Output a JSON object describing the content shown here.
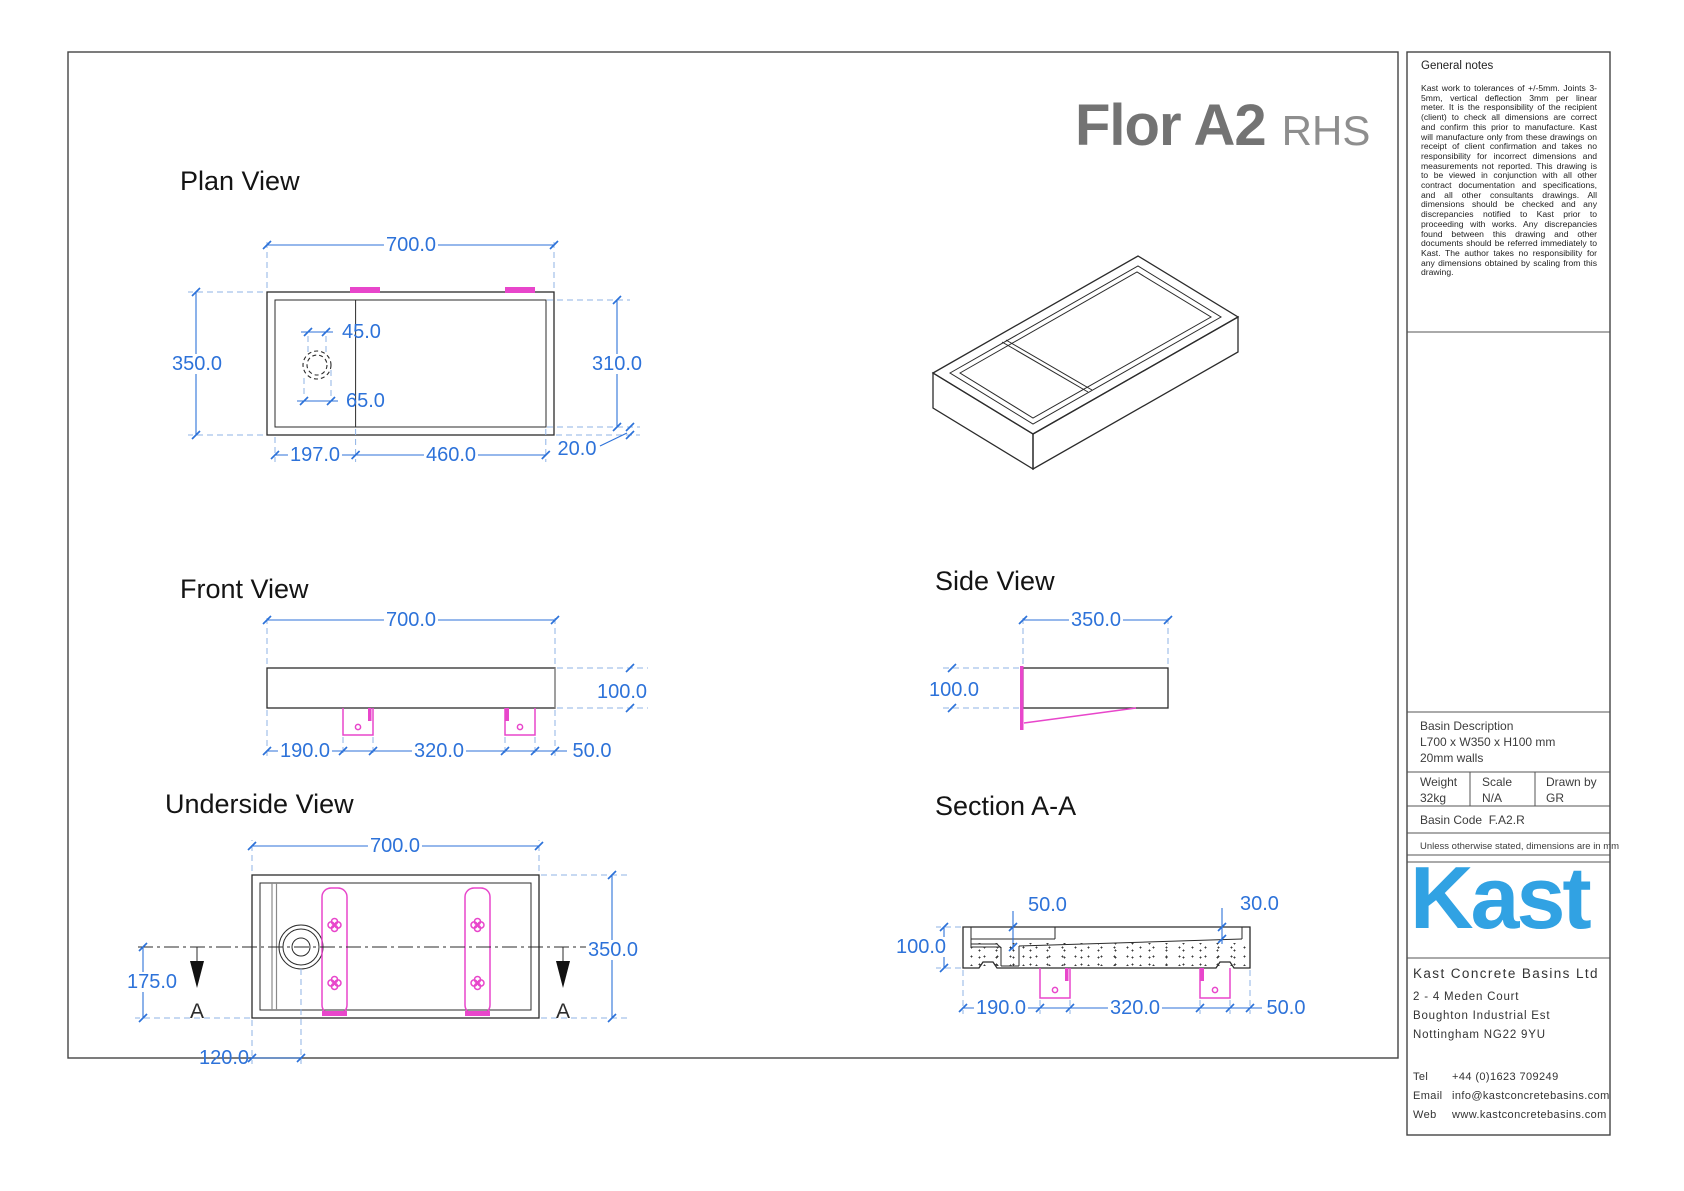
{
  "page": {
    "product_title": "Flor A2",
    "product_variant": "RHS"
  },
  "plan_view": {
    "title": "Plan View",
    "dim_width": "700.0",
    "dim_depth": "350.0",
    "dim_inner_depth": "310.0",
    "dim_wall": "20.0",
    "dim_drain_a": "45.0",
    "dim_drain_b": "65.0",
    "dim_shelf": "197.0",
    "dim_bowl": "460.0"
  },
  "front_view": {
    "title": "Front View",
    "dim_width": "700.0",
    "dim_height": "100.0",
    "dim_left": "190.0",
    "dim_centers": "320.0",
    "dim_right": "50.0"
  },
  "side_view": {
    "title": "Side View",
    "dim_depth": "350.0",
    "dim_height": "100.0"
  },
  "underside_view": {
    "title": "Underside View",
    "dim_width": "700.0",
    "dim_depth": "350.0",
    "dim_section": "175.0",
    "dim_drain": "120.0",
    "marker": "A"
  },
  "section_view": {
    "title": "Section A-A",
    "dim_depth_drain": "50.0",
    "dim_depth_end": "30.0",
    "dim_height": "100.0",
    "dim_left": "190.0",
    "dim_centers": "320.0",
    "dim_right": "50.0"
  },
  "notes": {
    "heading": "General notes",
    "body": "Kast work to tolerances of +/-5mm. Joints 3-5mm, vertical deflection 3mm per linear meter. It is the responsibility of the recipient (client) to check all dimensions are correct and confirm this prior to manufacture. Kast will manufacture only from these drawings on receipt of client confirmation and takes no responsibility for incorrect dimensions and measurements not reported. This drawing is to be viewed in conjunction with all other contract documentation and specifications, and all other consultants drawings. All dimensions should be checked and any discrepancies notified to Kast prior to proceeding with works. Any discrepancies found between this drawing and other documents should be referred immediately to Kast. The author takes no responsibility for any dimensions obtained by scaling from this drawing."
  },
  "title_block": {
    "basin_description_label": "Basin Description",
    "basin_dimensions": "L700 x W350 x H100 mm",
    "basin_walls": "20mm walls",
    "weight_label": "Weight",
    "weight_value": "32kg",
    "scale_label": "Scale",
    "scale_value": "N/A",
    "drawn_by_label": "Drawn by",
    "drawn_by_value": "GR",
    "basin_code_label": "Basin Code",
    "basin_code_value": "F.A2.R",
    "units_note": "Unless otherwise stated, dimensions are in mm"
  },
  "branding": {
    "logo_text": "Kast",
    "logo_color": "#31a2e3"
  },
  "company": {
    "name": "Kast Concrete Basins Ltd",
    "address_line1": "2 - 4 Meden Court",
    "address_line2": "Boughton Industrial Est",
    "address_line3": "Nottingham NG22 9YU",
    "tel_label": "Tel",
    "tel_value": "+44 (0)1623 709249",
    "email_label": "Email",
    "email_value": "info@kastconcretebasins.com",
    "web_label": "Web",
    "web_value": "www.kastconcretebasins.com"
  },
  "colors": {
    "dimension_blue": "#2d72d9",
    "magenta": "#e846cb",
    "logo_blue": "#31a2e3"
  }
}
